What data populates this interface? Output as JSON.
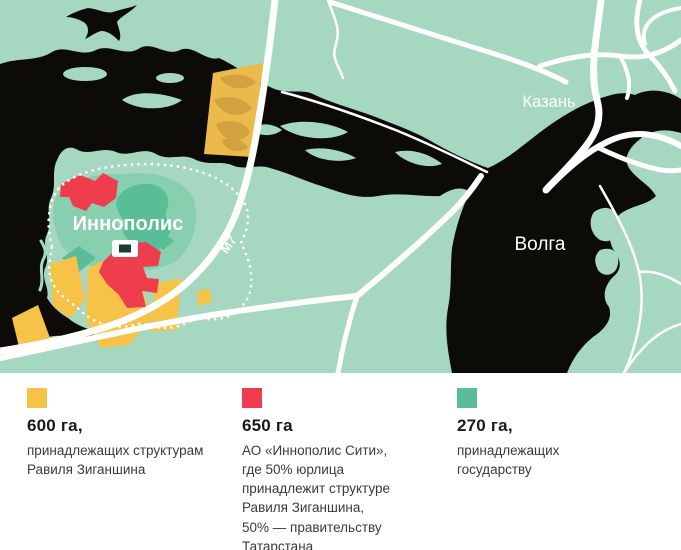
{
  "map": {
    "labels": {
      "city": "Казань",
      "river": "Волга",
      "town": "Иннополис",
      "road": "М7"
    },
    "colors": {
      "land": "#a6d8c1",
      "water": "#0d0b07",
      "road": "#ffffff",
      "state_green": "#59bd97",
      "mid_green": "#87cfae",
      "ziganshin_yellow": "#f6c348",
      "joint_red": "#ee3e4e"
    }
  },
  "legend": {
    "items": [
      {
        "area": "600 га,",
        "description": "принадлежащих структурам\nРавиля Зиганшина",
        "color": "#f6c348"
      },
      {
        "area": "650 га",
        "description": "АО «Иннополис Сити»,\nгде 50% юрлица\nпринадлежит структуре\nРавиля Зиганшина,\n50% — правительству\nТатарстана",
        "color": "#ee3e4e"
      },
      {
        "area": "270 га,",
        "description": "принадлежащих\nгосударству",
        "color": "#59bd97"
      }
    ]
  }
}
